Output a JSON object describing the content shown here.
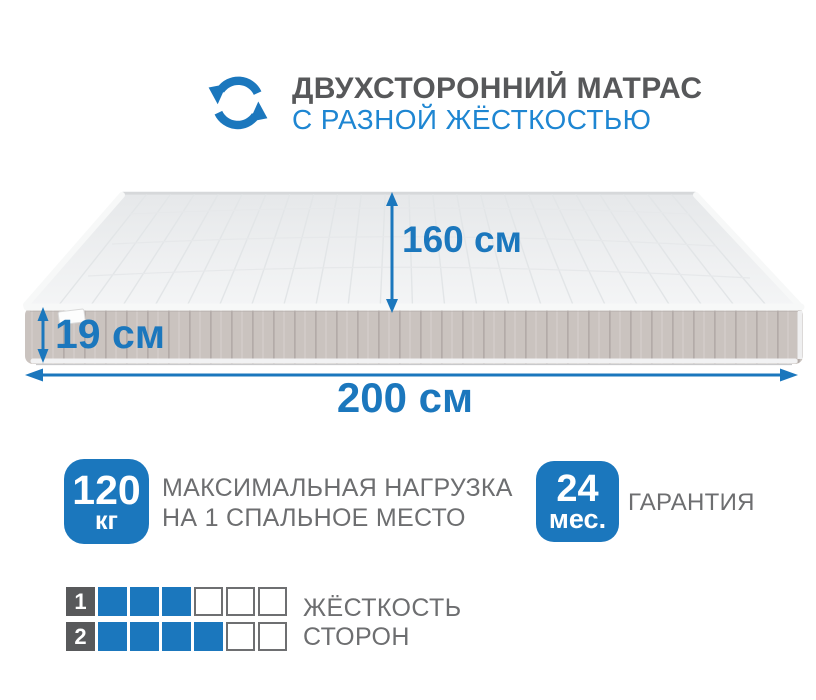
{
  "header": {
    "title": "ДВУХСТОРОННИЙ МАТРАС",
    "subtitle": "С РАЗНОЙ ЖЁСТКОСТЬЮ",
    "icon": "rotate-arrows-icon"
  },
  "dimensions": {
    "width_label": "160 см",
    "height_label": "19 см",
    "length_label": "200 см"
  },
  "badges": {
    "max_load": {
      "value": "120",
      "unit": "кг",
      "text_line1": "МАКСИМАЛЬНАЯ НАГРУЗКА",
      "text_line2": "НА 1 СПАЛЬНОЕ МЕСТО"
    },
    "warranty": {
      "value": "24",
      "unit": "мес.",
      "text": "ГАРАНТИЯ"
    }
  },
  "hardness": {
    "label_line1": "ЖЁСТКОСТЬ",
    "label_line2": "СТОРОН",
    "rows": [
      {
        "number": "1",
        "filled": 3,
        "total": 6
      },
      {
        "number": "2",
        "filled": 4,
        "total": 6
      }
    ]
  },
  "colors": {
    "accent-blue": "#1b77bd",
    "subtitle-blue": "#1e86d2",
    "title-gray": "#57585a",
    "text-gray": "#6d6e70",
    "number-square-gray": "#58595b",
    "mattress-side": "#cac3bf",
    "mattress-top": "#eef0f1"
  }
}
